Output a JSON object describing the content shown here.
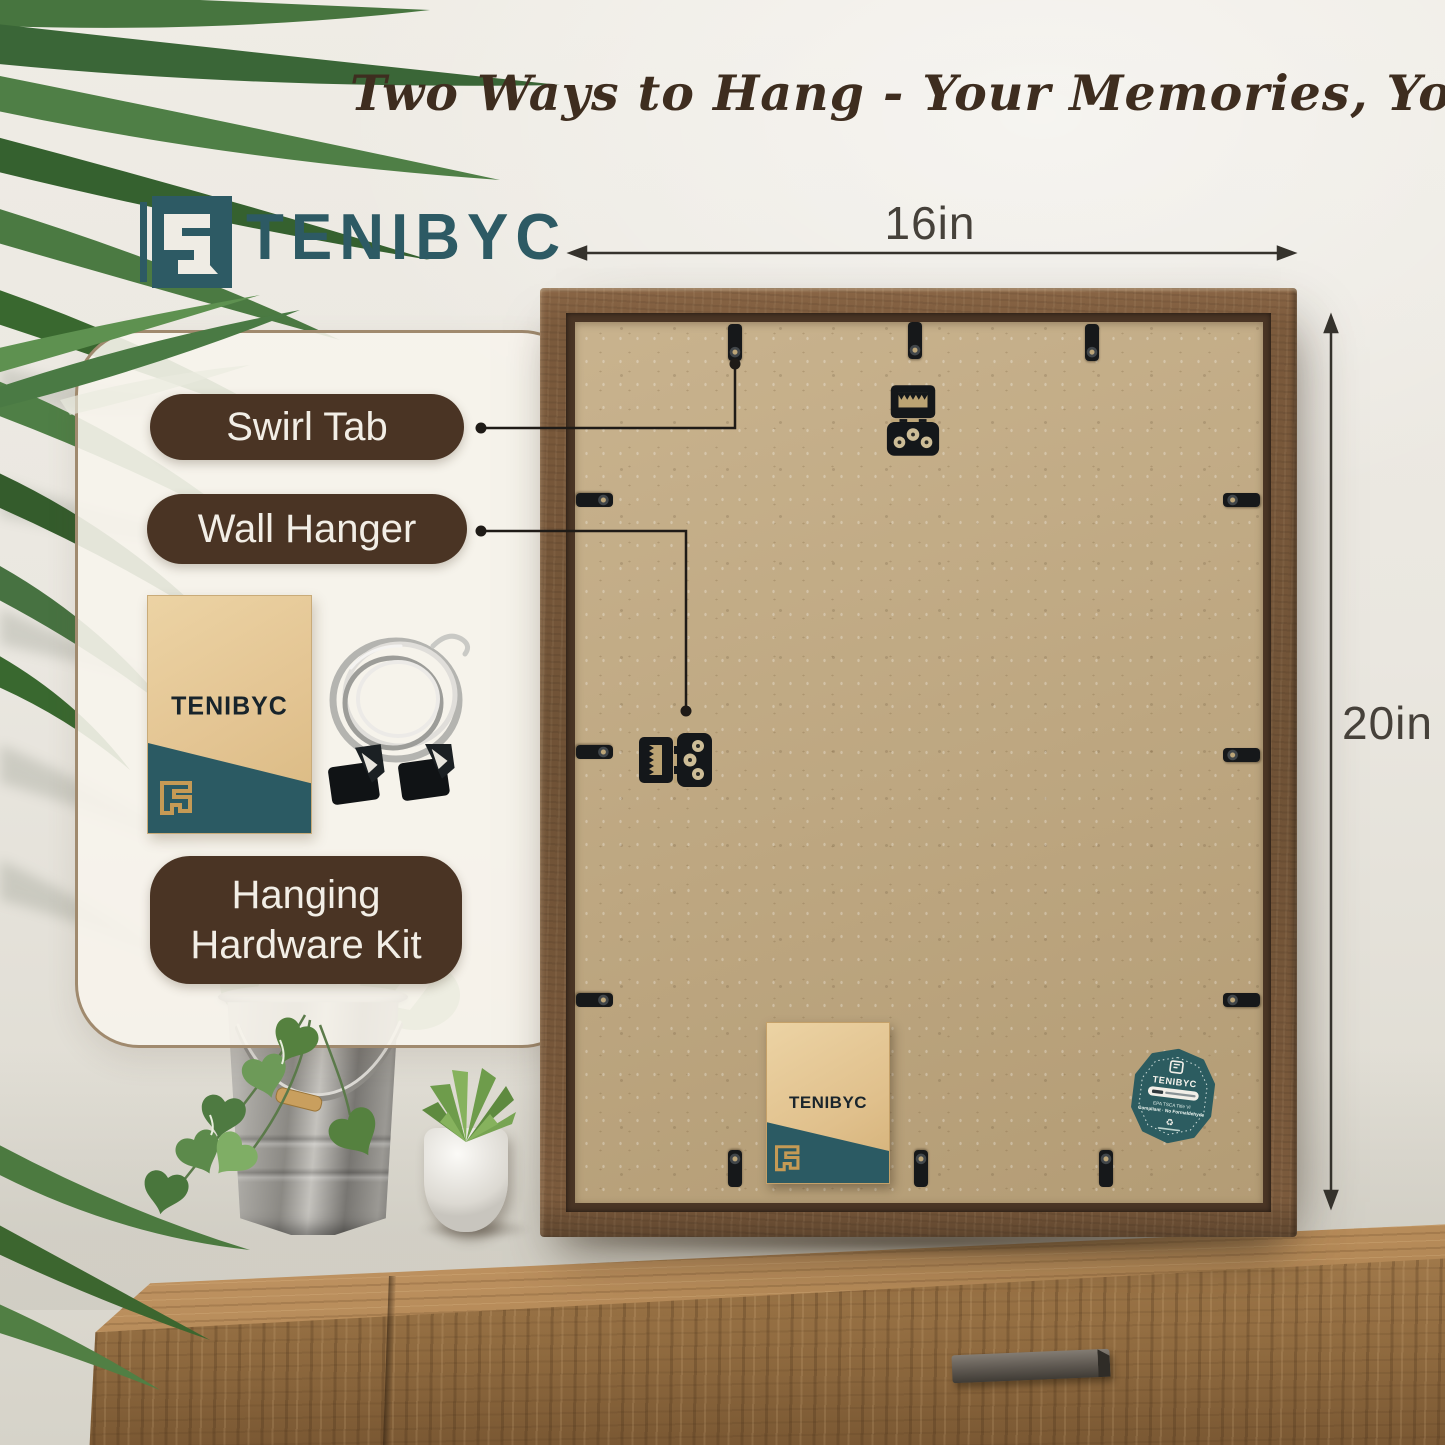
{
  "headline": "Two Ways to Hang - Your Memories, Your Style!",
  "brand": {
    "name": "TENIBYC"
  },
  "dimensions": {
    "width_label": "16in",
    "height_label": "20in"
  },
  "callouts": {
    "swirl_tab": "Swirl Tab",
    "wall_hanger": "Wall Hanger",
    "hardware_kit_line1": "Hanging",
    "hardware_kit_line2": "Hardware Kit"
  },
  "kit_envelope": {
    "brand": "TENIBYC"
  },
  "frame_card": {
    "brand": "TENIBYC"
  },
  "badge": {
    "brand": "TENIBYC",
    "cert_line1": "EPA TSCA Title VI",
    "cert_line2": "Compliant · No Formaldehyde"
  },
  "colors": {
    "brand_teal": "#2d5a64",
    "label_brown": "#4a3424",
    "headline_brown": "#3e2d1f",
    "frame_wood": "#7b5a3c",
    "backboard_kraft": "#c1a87e",
    "badge_teal": "#2c5c60"
  }
}
